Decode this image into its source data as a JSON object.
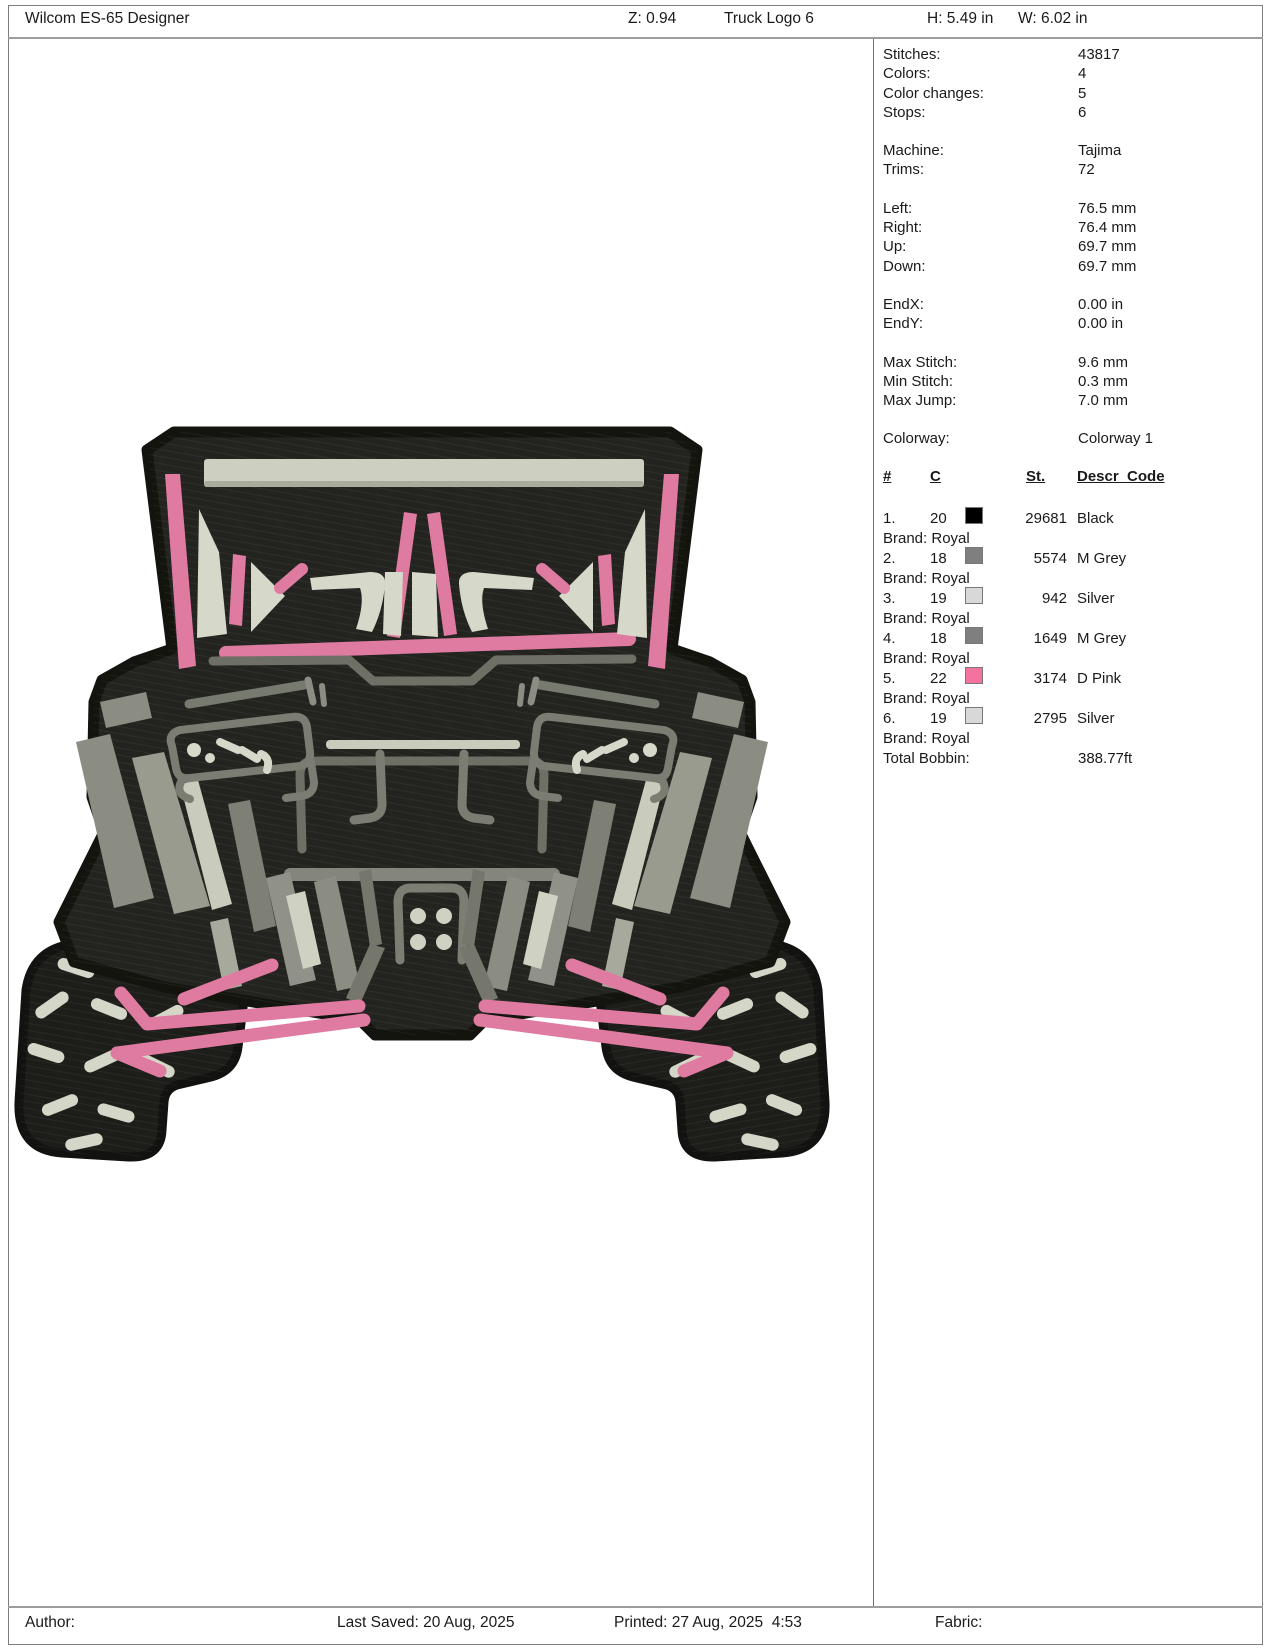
{
  "header": {
    "app_title": "Wilcom ES-65 Designer",
    "zoom_label": "Z: 0.94",
    "design_name": "Truck Logo 6",
    "height_label": "H: 5.49 in",
    "width_label": "W: 6.02 in"
  },
  "footer": {
    "author_label": "Author:",
    "last_saved": "Last Saved: 20 Aug, 2025",
    "printed": "Printed: 27 Aug, 2025  4:53",
    "fabric_label": "Fabric:"
  },
  "info_groups": [
    {
      "rows": [
        {
          "label": "Stitches:",
          "value": "43817"
        },
        {
          "label": "Colors:",
          "value": "4"
        },
        {
          "label": "Color changes:",
          "value": "5"
        },
        {
          "label": "Stops:",
          "value": "6"
        }
      ]
    },
    {
      "rows": [
        {
          "label": "Machine:",
          "value": "Tajima"
        },
        {
          "label": "Trims:",
          "value": "72"
        }
      ]
    },
    {
      "rows": [
        {
          "label": "Left:",
          "value": "76.5 mm"
        },
        {
          "label": "Right:",
          "value": "76.4 mm"
        },
        {
          "label": "Up:",
          "value": "69.7 mm"
        },
        {
          "label": "Down:",
          "value": "69.7 mm"
        }
      ]
    },
    {
      "rows": [
        {
          "label": "EndX:",
          "value": "0.00 in"
        },
        {
          "label": "EndY:",
          "value": "0.00 in"
        }
      ]
    },
    {
      "rows": [
        {
          "label": "Max Stitch:",
          "value": "9.6 mm"
        },
        {
          "label": "Min Stitch:",
          "value": "0.3 mm"
        },
        {
          "label": "Max Jump:",
          "value": "7.0 mm"
        }
      ]
    }
  ],
  "colorway": {
    "label": "Colorway:",
    "value": "Colorway 1"
  },
  "color_table": {
    "headers": {
      "num": "#",
      "c": "C",
      "st": "St.",
      "descr": "Descr_Code"
    },
    "rows": [
      {
        "num": "1.",
        "c": "20",
        "swatch": "#000000",
        "st": "29681",
        "descr": "Black",
        "brand": "Brand: Royal"
      },
      {
        "num": "2.",
        "c": "18",
        "swatch": "#7f7f7f",
        "st": "5574",
        "descr": "M Grey",
        "brand": "Brand: Royal"
      },
      {
        "num": "3.",
        "c": "19",
        "swatch": "#d8d8d8",
        "st": "942",
        "descr": "Silver",
        "brand": "Brand: Royal"
      },
      {
        "num": "4.",
        "c": "18",
        "swatch": "#7f7f7f",
        "st": "1649",
        "descr": "M Grey",
        "brand": "Brand: Royal"
      },
      {
        "num": "5.",
        "c": "22",
        "swatch": "#f472a0",
        "st": "3174",
        "descr": "D Pink",
        "brand": "Brand: Royal"
      },
      {
        "num": "6.",
        "c": "19",
        "swatch": "#d8d8d8",
        "st": "2795",
        "descr": "Silver",
        "brand": "Brand: Royal"
      }
    ],
    "total": {
      "label": "Total Bobbin:",
      "value": "388.77ft"
    }
  },
  "design_palette": {
    "outline_black": "#141410",
    "body_charcoal": "#23241f",
    "mid_grey": "#84867b",
    "tube_grey": "#6e7066",
    "silver": "#d4d6c8",
    "pink": "#df7aa1"
  }
}
